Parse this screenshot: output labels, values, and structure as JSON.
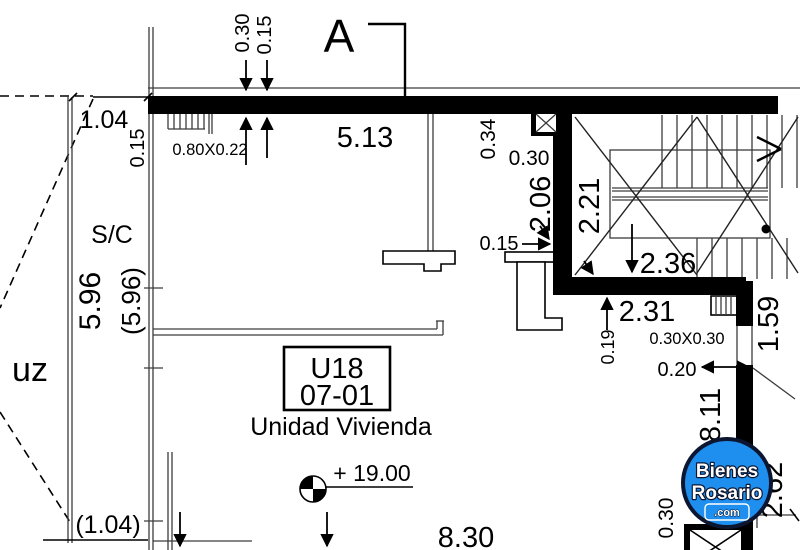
{
  "document": {
    "type": "floor-plan"
  },
  "colors": {
    "wall": "#000000",
    "logo_blue": "#1E8FEF",
    "logo_ring": "#0C1631",
    "logo_text": "#FFFFFF"
  },
  "section": {
    "marker": "A"
  },
  "unit": {
    "code": "U18",
    "number": "07-01",
    "type": "Unidad Vivienda",
    "level": "+ 19.00"
  },
  "rooms": {
    "service": "S/C",
    "light_well_partial": "uz"
  },
  "window": {
    "label": "0.80X0.22"
  },
  "column": {
    "label": "0.30X0.30"
  },
  "dimensions": {
    "top_030": "0.30",
    "top_015": "0.15",
    "left_104": "1.04",
    "left_015": "0.15",
    "width_513": "5.13",
    "wall_034": "0.34",
    "wall_030": "0.30",
    "stair_206": "2.06",
    "stair_221": "2.21",
    "wall_015": "0.15",
    "stair_236": "2.36",
    "hall_231": "2.31",
    "wall_019": "0.19",
    "gap_020": "0.20",
    "right_159": "1.59",
    "right_811": "8.11",
    "right_262": "2.62",
    "bottom_030": "0.30",
    "bottom_830": "8.30",
    "left_596": "5.96",
    "left_596_paren": "(5.96)",
    "left_104_paren": "(1.04)"
  },
  "watermark": {
    "line1": "Bienes",
    "line2": "Rosario",
    "line3": ".com"
  }
}
